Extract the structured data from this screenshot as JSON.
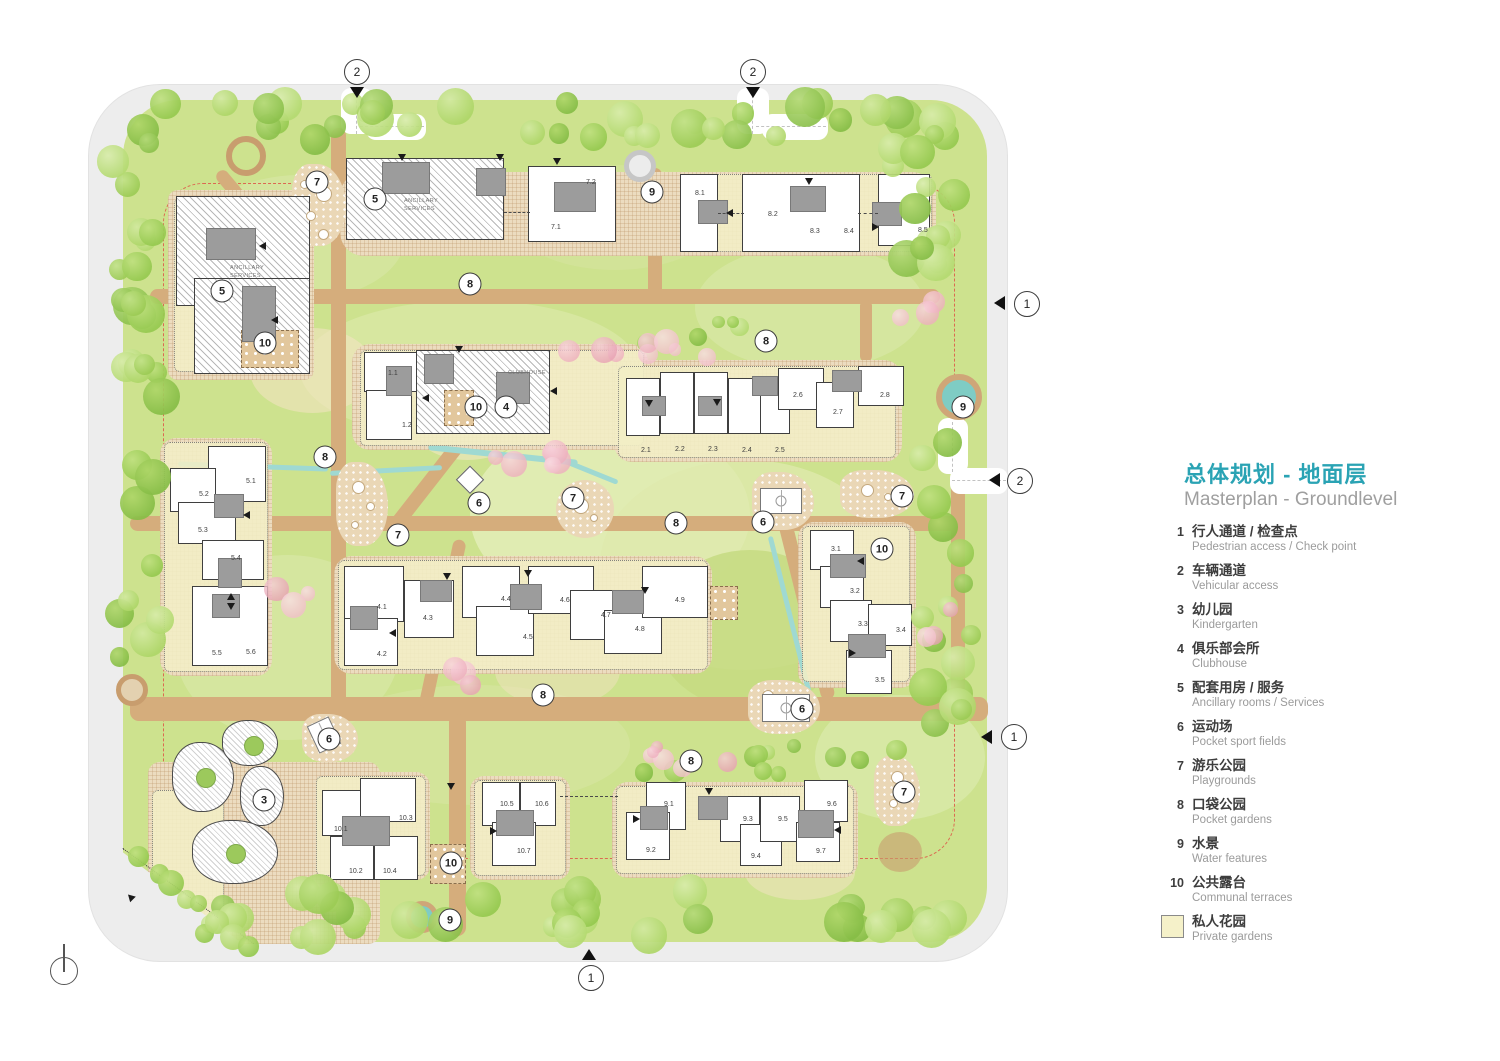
{
  "header": {
    "title_zh": "总体规划 - 地面层",
    "title_en": "Masterplan - Groundlevel"
  },
  "legend": {
    "swatch_color": "#f5f1c9",
    "items": [
      {
        "num": "1",
        "zh": "行人通道 / 检查点",
        "en": "Pedestrian access / Check point"
      },
      {
        "num": "2",
        "zh": "车辆通道",
        "en": "Vehicular access"
      },
      {
        "num": "3",
        "zh": "幼儿园",
        "en": "Kindergarten"
      },
      {
        "num": "4",
        "zh": "俱乐部会所",
        "en": "Clubhouse"
      },
      {
        "num": "5",
        "zh": "配套用房 / 服务",
        "en": "Ancillary rooms / Services"
      },
      {
        "num": "6",
        "zh": "运动场",
        "en": "Pocket sport fields"
      },
      {
        "num": "7",
        "zh": "游乐公园",
        "en": "Playgrounds"
      },
      {
        "num": "8",
        "zh": "口袋公园",
        "en": "Pocket gardens"
      },
      {
        "num": "9",
        "zh": "水景",
        "en": "Water features"
      },
      {
        "num": "10",
        "zh": "公共露台",
        "en": "Communal terraces"
      },
      {
        "swatch": true,
        "zh": "私人花园",
        "en": "Private gardens"
      }
    ]
  },
  "plan": {
    "building_texts": [
      {
        "t": "ANCILLARY\nSERVICES",
        "x": 230,
        "y": 264
      },
      {
        "t": "ANCILLARY\nSERVICES",
        "x": 404,
        "y": 197
      },
      {
        "t": "CLUBHOUSE",
        "x": 508,
        "y": 369
      }
    ],
    "unit_labels": [
      {
        "t": "7.1",
        "x": 551,
        "y": 224
      },
      {
        "t": "7.2",
        "x": 586,
        "y": 179
      },
      {
        "t": "8.1",
        "x": 695,
        "y": 190
      },
      {
        "t": "8.2",
        "x": 768,
        "y": 211
      },
      {
        "t": "8.3",
        "x": 810,
        "y": 228
      },
      {
        "t": "8.4",
        "x": 844,
        "y": 228
      },
      {
        "t": "8.5",
        "x": 918,
        "y": 227
      },
      {
        "t": "1.1",
        "x": 388,
        "y": 370
      },
      {
        "t": "1.2",
        "x": 402,
        "y": 422
      },
      {
        "t": "2.1",
        "x": 641,
        "y": 447
      },
      {
        "t": "2.2",
        "x": 675,
        "y": 446
      },
      {
        "t": "2.3",
        "x": 708,
        "y": 446
      },
      {
        "t": "2.4",
        "x": 742,
        "y": 447
      },
      {
        "t": "2.5",
        "x": 775,
        "y": 447
      },
      {
        "t": "2.6",
        "x": 793,
        "y": 392
      },
      {
        "t": "2.7",
        "x": 833,
        "y": 409
      },
      {
        "t": "2.8",
        "x": 880,
        "y": 392
      },
      {
        "t": "5.1",
        "x": 246,
        "y": 478
      },
      {
        "t": "5.2",
        "x": 199,
        "y": 491
      },
      {
        "t": "5.3",
        "x": 198,
        "y": 527
      },
      {
        "t": "5.4",
        "x": 231,
        "y": 555
      },
      {
        "t": "5.5",
        "x": 212,
        "y": 650
      },
      {
        "t": "5.6",
        "x": 246,
        "y": 649
      },
      {
        "t": "4.1",
        "x": 377,
        "y": 604
      },
      {
        "t": "4.2",
        "x": 377,
        "y": 651
      },
      {
        "t": "4.3",
        "x": 423,
        "y": 615
      },
      {
        "t": "4.4",
        "x": 501,
        "y": 596
      },
      {
        "t": "4.5",
        "x": 523,
        "y": 634
      },
      {
        "t": "4.6",
        "x": 560,
        "y": 597
      },
      {
        "t": "4.7",
        "x": 601,
        "y": 612
      },
      {
        "t": "4.8",
        "x": 635,
        "y": 626
      },
      {
        "t": "4.9",
        "x": 675,
        "y": 597
      },
      {
        "t": "3.1",
        "x": 831,
        "y": 546
      },
      {
        "t": "3.2",
        "x": 850,
        "y": 588
      },
      {
        "t": "3.3",
        "x": 858,
        "y": 621
      },
      {
        "t": "3.4",
        "x": 896,
        "y": 627
      },
      {
        "t": "3.5",
        "x": 875,
        "y": 677
      },
      {
        "t": "10.1",
        "x": 334,
        "y": 826
      },
      {
        "t": "10.2",
        "x": 349,
        "y": 868
      },
      {
        "t": "10.3",
        "x": 399,
        "y": 815
      },
      {
        "t": "10.4",
        "x": 383,
        "y": 868
      },
      {
        "t": "10.5",
        "x": 500,
        "y": 801
      },
      {
        "t": "10.6",
        "x": 535,
        "y": 801
      },
      {
        "t": "10.7",
        "x": 517,
        "y": 848
      },
      {
        "t": "9.1",
        "x": 664,
        "y": 801
      },
      {
        "t": "9.2",
        "x": 646,
        "y": 847
      },
      {
        "t": "9.3",
        "x": 743,
        "y": 816
      },
      {
        "t": "9.4",
        "x": 751,
        "y": 853
      },
      {
        "t": "9.5",
        "x": 778,
        "y": 816
      },
      {
        "t": "9.6",
        "x": 827,
        "y": 801
      },
      {
        "t": "9.7",
        "x": 816,
        "y": 848
      }
    ],
    "markers": [
      {
        "n": "7",
        "x": 317,
        "y": 182
      },
      {
        "n": "5",
        "x": 375,
        "y": 199
      },
      {
        "n": "5",
        "x": 222,
        "y": 291
      },
      {
        "n": "10",
        "x": 265,
        "y": 343
      },
      {
        "n": "8",
        "x": 470,
        "y": 284
      },
      {
        "n": "9",
        "x": 652,
        "y": 192
      },
      {
        "n": "8",
        "x": 766,
        "y": 341
      },
      {
        "n": "9",
        "x": 963,
        "y": 407
      },
      {
        "n": "10",
        "x": 476,
        "y": 407
      },
      {
        "n": "4",
        "x": 506,
        "y": 407
      },
      {
        "n": "8",
        "x": 325,
        "y": 457
      },
      {
        "n": "7",
        "x": 398,
        "y": 535
      },
      {
        "n": "6",
        "x": 479,
        "y": 503
      },
      {
        "n": "7",
        "x": 573,
        "y": 498
      },
      {
        "n": "8",
        "x": 676,
        "y": 523
      },
      {
        "n": "6",
        "x": 763,
        "y": 522
      },
      {
        "n": "7",
        "x": 902,
        "y": 496
      },
      {
        "n": "10",
        "x": 882,
        "y": 549
      },
      {
        "n": "6",
        "x": 802,
        "y": 709
      },
      {
        "n": "8",
        "x": 543,
        "y": 695
      },
      {
        "n": "6",
        "x": 329,
        "y": 739
      },
      {
        "n": "3",
        "x": 264,
        "y": 800
      },
      {
        "n": "8",
        "x": 691,
        "y": 761
      },
      {
        "n": "7",
        "x": 904,
        "y": 792
      },
      {
        "n": "10",
        "x": 451,
        "y": 863
      },
      {
        "n": "9",
        "x": 450,
        "y": 920
      }
    ],
    "entrances": [
      {
        "n": "2",
        "x": 357,
        "y": 72,
        "ax": 357,
        "ay": 94,
        "dir": "d"
      },
      {
        "n": "2",
        "x": 753,
        "y": 72,
        "ax": 753,
        "ay": 94,
        "dir": "d"
      },
      {
        "n": "1",
        "x": 1027,
        "y": 304,
        "ax": 1001,
        "ay": 303,
        "dir": "l"
      },
      {
        "n": "2",
        "x": 1020,
        "y": 481,
        "ax": 996,
        "ay": 480,
        "dir": "l"
      },
      {
        "n": "1",
        "x": 1014,
        "y": 737,
        "ax": 988,
        "ay": 737,
        "dir": "l"
      },
      {
        "n": "1",
        "x": 591,
        "y": 978,
        "ax": 589,
        "ay": 956,
        "dir": "u"
      }
    ]
  }
}
